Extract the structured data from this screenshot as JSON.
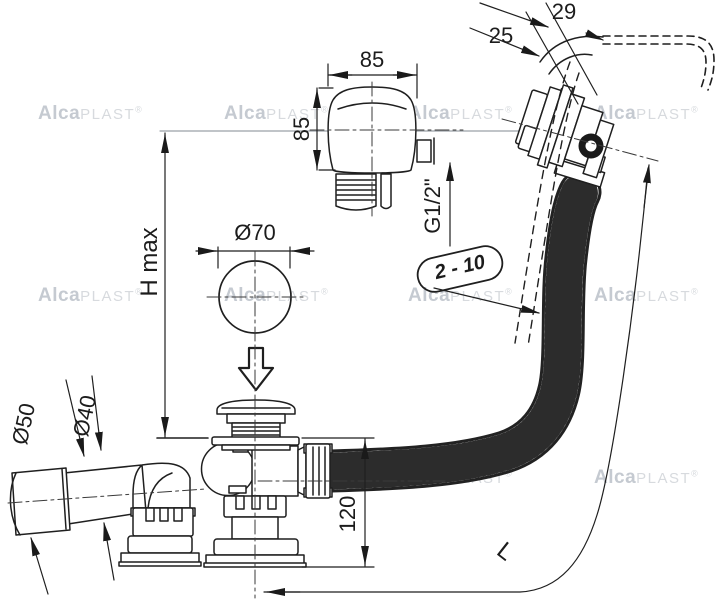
{
  "title": "Bath waste, overflow and filling set - technical drawing",
  "watermark": {
    "bold": "Alca",
    "light": "PLAST",
    "reg": "®"
  },
  "dimensions": {
    "knob_width": "85",
    "knob_height": "85",
    "thread": "G1/2\"",
    "overflow_offset": "29",
    "overflow_inner": "25",
    "plug_diameter": "Ø70",
    "height_max": "H max",
    "wall_thickness_range": "2 - 10",
    "outlet_sleeve_diameter": "Ø50",
    "outlet_pipe_diameter": "Ø40",
    "trap_height": "120",
    "hose_length": "L"
  }
}
